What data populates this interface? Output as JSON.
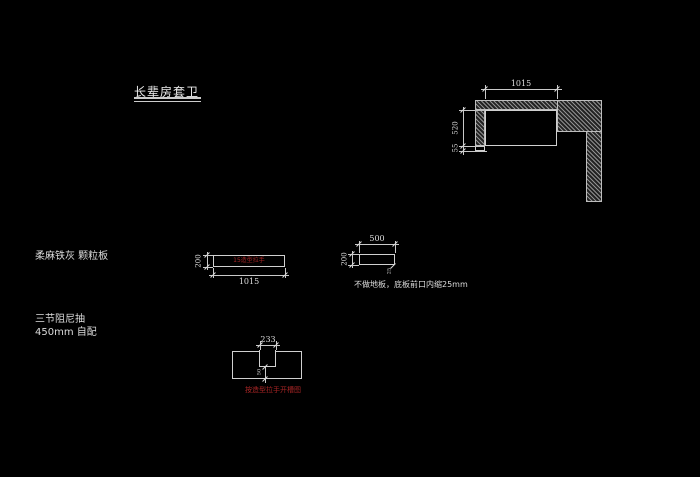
{
  "title": "长辈房套卫",
  "colors": {
    "background": "#000000",
    "line": "#c9c9c9",
    "red_text": "#a72525"
  },
  "corner_plan": {
    "dim_width": "1015",
    "dim_height": "520",
    "dim_kick": "55"
  },
  "panel": {
    "material_label": "柔麻铁灰 颗粒板",
    "red_note": "15造型拉手",
    "dim_height": "200",
    "dim_width": "1015"
  },
  "bottom_board": {
    "dim_width": "500",
    "dim_height": "200",
    "dim_inset": "25",
    "note": "不做地板，底板前口内缩25mm"
  },
  "drawer": {
    "label_line1": "三节阻尼抽",
    "label_line2": "450mm 自配",
    "dim_notch_width": "233",
    "dim_notch_depth": "50",
    "red_note": "按造型拉手开槽图"
  }
}
